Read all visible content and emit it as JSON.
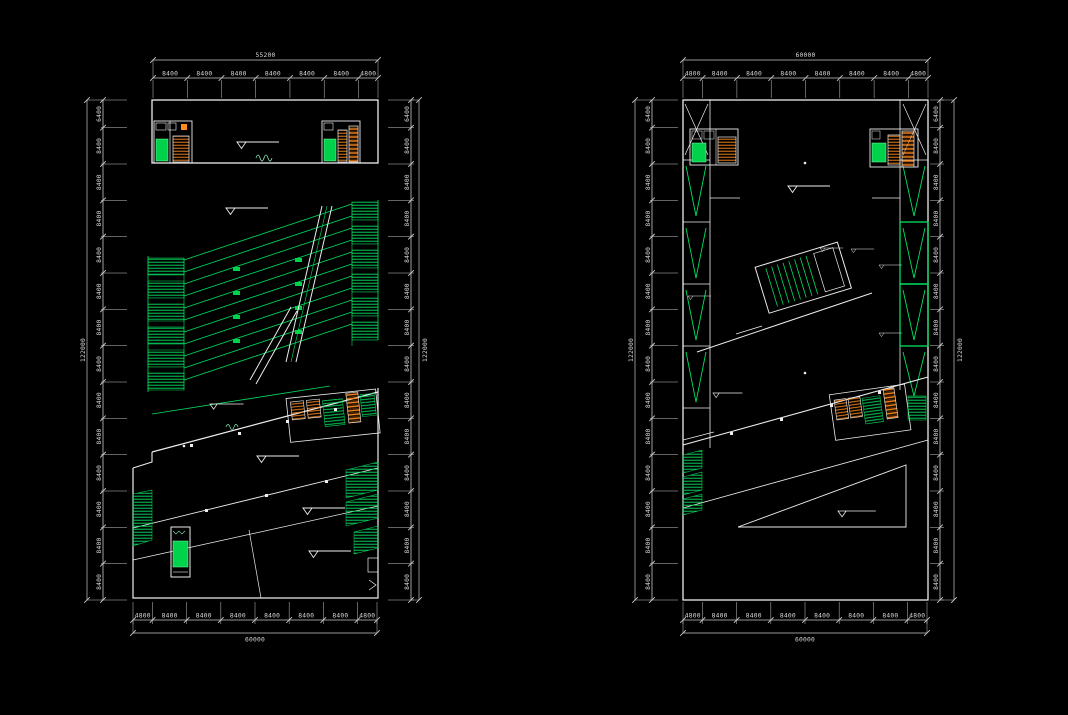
{
  "app": {
    "type": "cad-floor-plan-drawing",
    "background": "#000000",
    "colors": {
      "wall_line": "#ededed",
      "green_line": "#00e060",
      "green_fill": "#00d24b",
      "stair_orange": "#ff8a1e",
      "dim_text": "#d8d8d8"
    }
  },
  "dimensions": {
    "left_plan": {
      "top": {
        "segments": [
          "8400",
          "8400",
          "8400",
          "8400",
          "8400",
          "8400",
          "4800"
        ],
        "total": "55200"
      },
      "bottom": {
        "segments": [
          "4800",
          "8400",
          "8400",
          "8400",
          "8400",
          "8400",
          "8400",
          "4800"
        ],
        "total": "60000"
      },
      "left": {
        "segments": [
          "6400",
          "8400",
          "8400",
          "8400",
          "8400",
          "8400",
          "8400",
          "8400",
          "8400",
          "8400",
          "8400",
          "8400",
          "8400",
          "8400"
        ],
        "total": "122000"
      },
      "right": {
        "segments": [
          "6400",
          "8400",
          "8400",
          "8400",
          "8400",
          "8400",
          "8400",
          "8400",
          "8400",
          "8400",
          "8400",
          "8400",
          "8400",
          "8400"
        ],
        "total": "122000"
      }
    },
    "right_plan": {
      "top": {
        "segments": [
          "4800",
          "8400",
          "8400",
          "8400",
          "8400",
          "8400",
          "8400",
          "4800"
        ],
        "total": "60000"
      },
      "bottom": {
        "segments": [
          "4800",
          "8400",
          "8400",
          "8400",
          "8400",
          "8400",
          "8400",
          "4800"
        ],
        "total": "60000"
      },
      "left": {
        "segments": [
          "6400",
          "8400",
          "8400",
          "8400",
          "8400",
          "8400",
          "8400",
          "8400",
          "8400",
          "8400",
          "8400",
          "8400",
          "8400",
          "8400"
        ],
        "total": "122000"
      },
      "right": {
        "segments": [
          "6400",
          "8400",
          "8400",
          "8400",
          "8400",
          "8400",
          "8400",
          "8400",
          "8400",
          "8400",
          "8400",
          "8400",
          "8400",
          "8400"
        ],
        "total": "122000"
      }
    }
  }
}
